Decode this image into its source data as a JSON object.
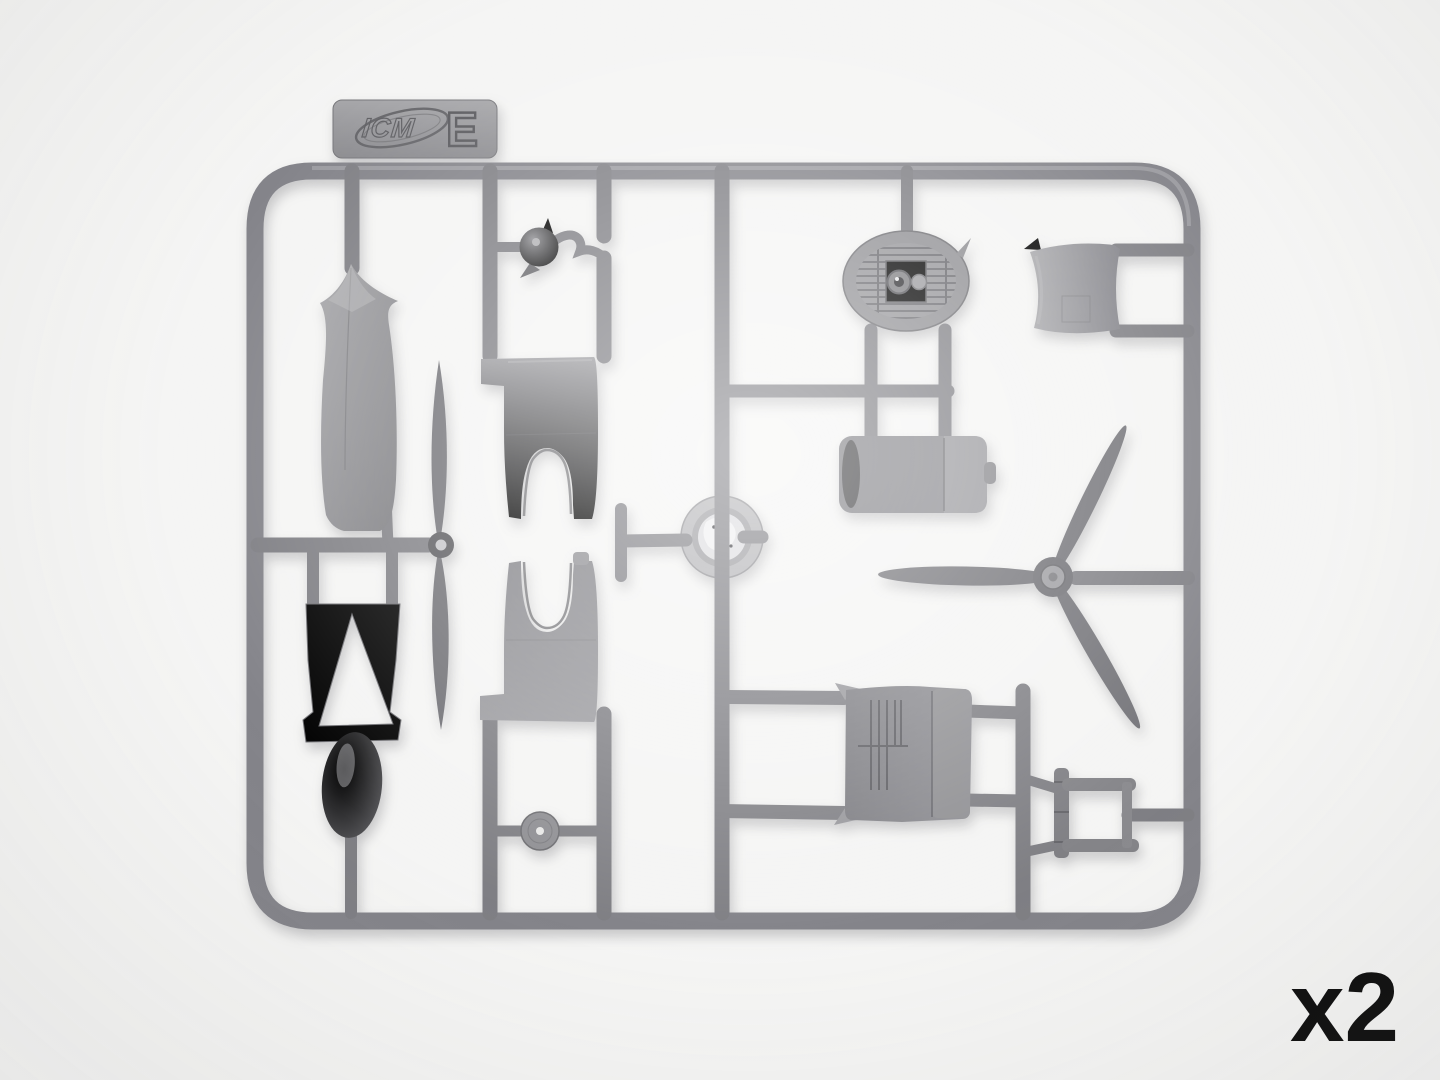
{
  "photo": {
    "description": "Gray injection-molded plastic model-kit sprue (frame E) with aircraft parts, photographed on a white background",
    "background_color": "#f5f5f4",
    "plastic_color": "#85858a",
    "text_color": "#0c0c0c",
    "labels": {
      "brand": "ICM",
      "sprue_letter": "E",
      "quantity": "x2"
    },
    "parts": [
      "fuselage-half",
      "two-blade-propeller",
      "fuselage-frame-with-triangular-cutout",
      "float-pontoon",
      "spinner-ball",
      "upper-cowling-half",
      "lower-cowling-half",
      "wheel-disc",
      "shiny-cowl-ring",
      "oval-radiator",
      "cylinder-drum",
      "curved-cowl-panel",
      "three-blade-propeller",
      "louvered-engine-cylinder",
      "engine-bearer-frame"
    ]
  }
}
